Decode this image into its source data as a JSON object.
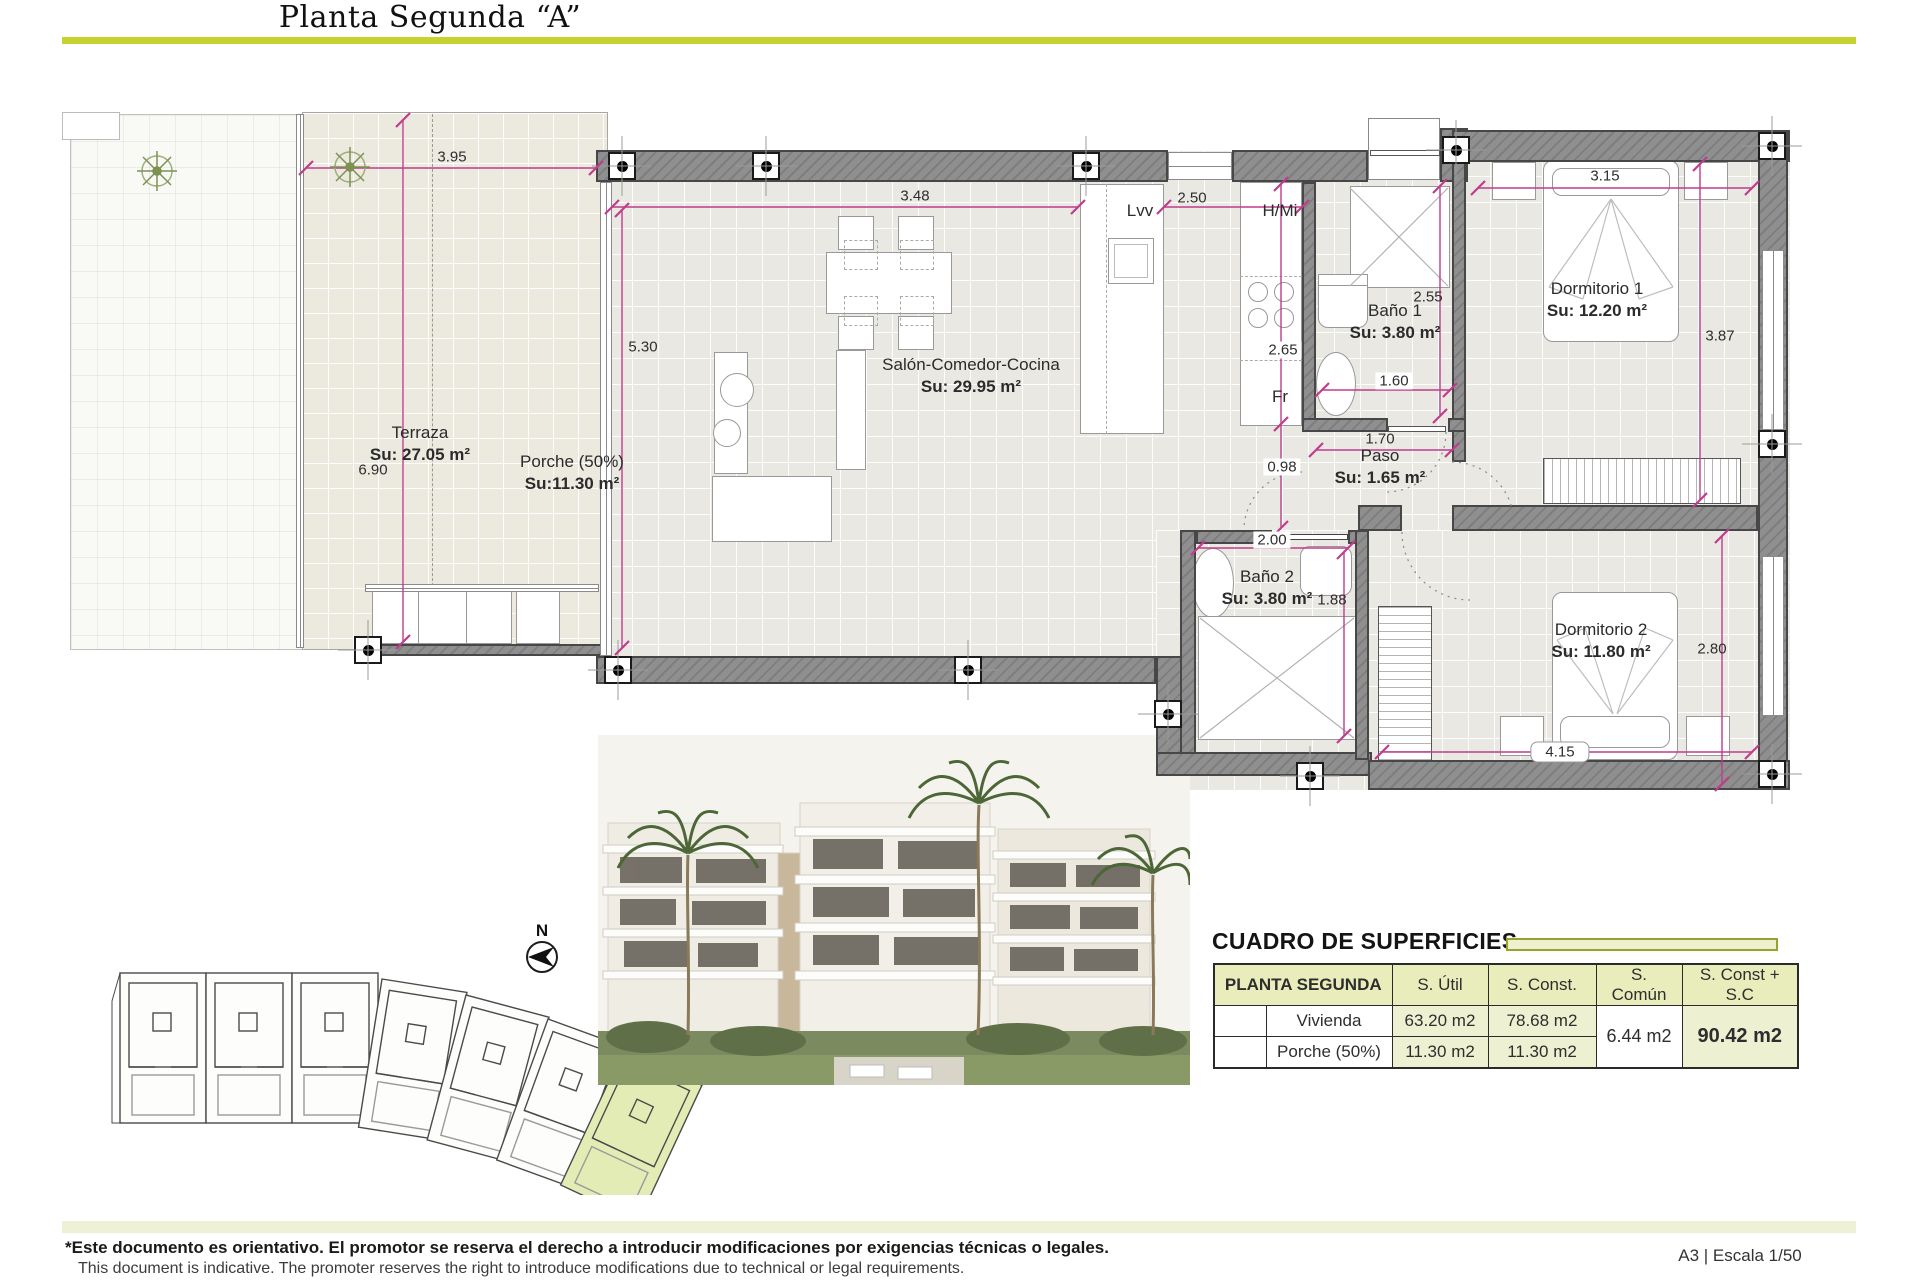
{
  "title": "Planta Segunda “A”",
  "colors": {
    "accent": "#c6d32f",
    "table_header_bg": "#e9edbc",
    "highlight_unit": "#e4ecb6",
    "dim_line": "#c03c8c",
    "wall": "#8f8f8f"
  },
  "plan": {
    "rooms": {
      "terraza": {
        "name": "Terraza",
        "area": "Su: 27.05 m²"
      },
      "porche": {
        "name": "Porche (50%)",
        "area": "Su:11.30 m²"
      },
      "salon": {
        "name": "Salón-Comedor-Cocina",
        "area": "Su: 29.95 m²"
      },
      "bano1": {
        "name": "Baño 1",
        "area": "Su: 3.80 m²"
      },
      "paso": {
        "name": "Paso",
        "area": "Su: 1.65 m²"
      },
      "bano2": {
        "name": "Baño 2",
        "area": "Su: 3.80 m²"
      },
      "dorm1": {
        "name": "Dormitorio 1",
        "area": "Su: 12.20 m²"
      },
      "dorm2": {
        "name": "Dormitorio 2",
        "area": "Su: 11.80 m²"
      }
    },
    "kitchen": {
      "dishwasher": "Lvv",
      "oven_micro": "H/Mi",
      "fridge": "Fr"
    },
    "dims": {
      "d395": "3.95",
      "d348": "3.48",
      "d250": "2.50",
      "d530": "5.30",
      "d690": "6.90",
      "d265": "2.65",
      "d098": "0.98",
      "d255": "2.55",
      "d160": "1.60",
      "d170": "1.70",
      "d200": "2.00",
      "d188": "1.88",
      "d315": "3.15",
      "d387": "3.87",
      "d280": "2.80",
      "d415": "4.15"
    },
    "north_label": "N"
  },
  "surfaces": {
    "title": "CUADRO DE SUPERFICIES",
    "headers": [
      "PLANTA SEGUNDA",
      "S. Útil",
      "S. Const.",
      "S. Común",
      "S. Const + S.C"
    ],
    "rows": [
      {
        "name": "Vivienda",
        "util": "63.20 m2",
        "construida": "78.68 m2"
      },
      {
        "name": "Porche (50%)",
        "util": "11.30 m2",
        "construida": "11.30 m2"
      }
    ],
    "comun": "6.44 m2",
    "total": "90.42 m2"
  },
  "footer": {
    "disclaimer_es": "*Este documento es orientativo. El promotor se reserva el derecho a introducir modificaciones por exigencias técnicas o legales.",
    "disclaimer_en": "This document is indicative. The promoter reserves the right to introduce modifications due to technical or legal requirements.",
    "sheet_scale": "A3 | Escala 1/50"
  }
}
